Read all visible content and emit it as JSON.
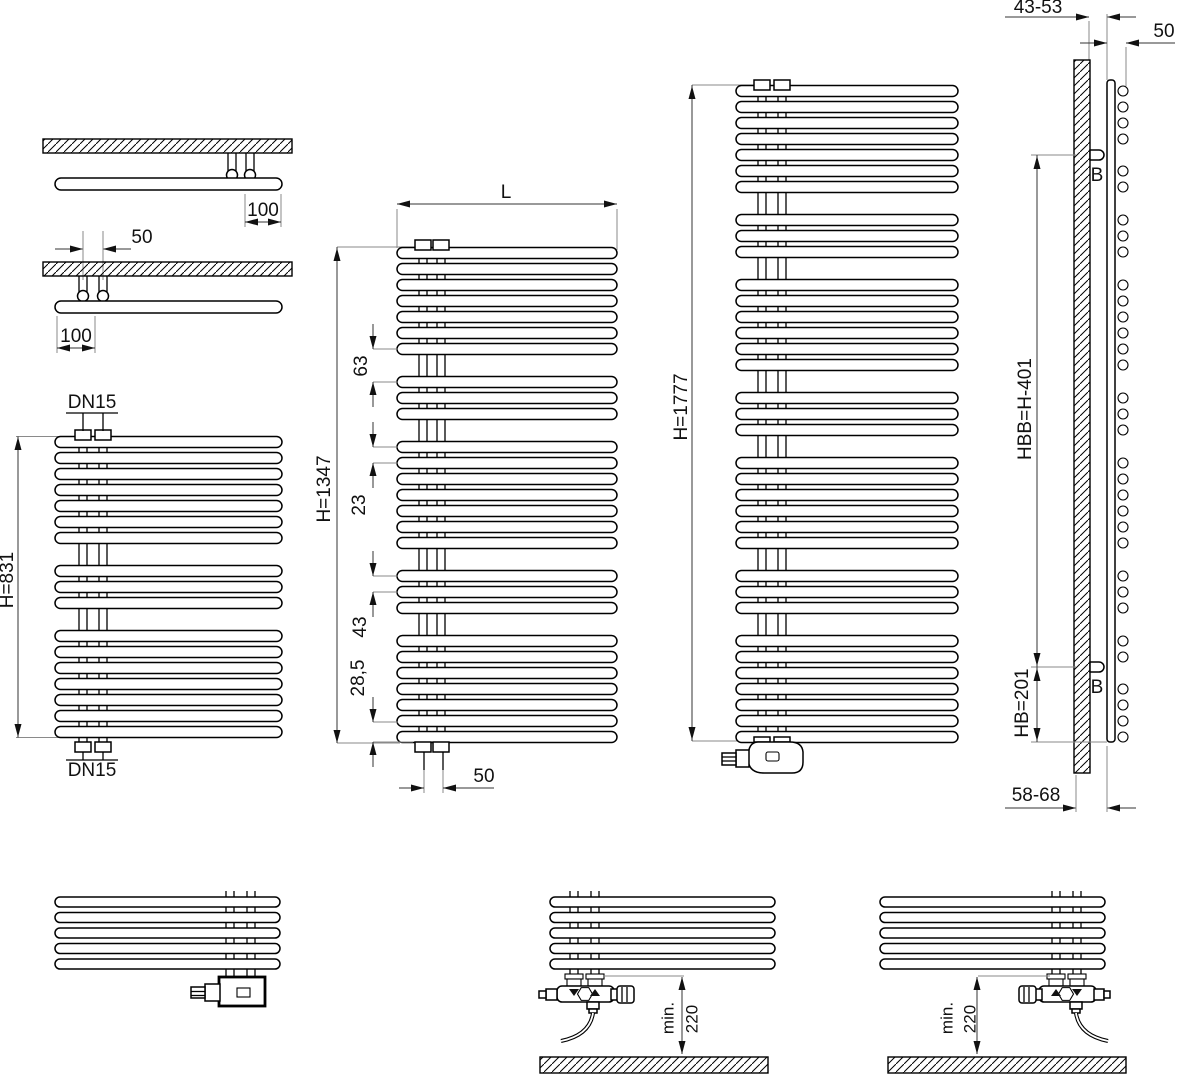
{
  "diagram": {
    "top_connection_detail": {
      "offset_right": "100",
      "pipe_spacing": "50",
      "offset_left": "100"
    },
    "radiator_h831": {
      "connection_top": "DN15",
      "connection_bottom": "DN15",
      "height": "H=831"
    },
    "radiator_h1347": {
      "width": "L",
      "height": "H=1347",
      "gap_pitch": "63",
      "tube_pitch": "23",
      "group_pitch": "43",
      "bottom_pitch": "28,5",
      "pipe_spacing": "50"
    },
    "radiator_h1777": {
      "height": "H=1777"
    },
    "side_view": {
      "wall_to_pipe": "43-53",
      "pipe_to_tube": "50",
      "bracket_top_label": "B",
      "bracket_distance": "HBB=H-401",
      "bracket_bottom_height": "HB=201",
      "bracket_bottom_label": "B",
      "wall_clearance": "58-68"
    },
    "installation_center": {
      "min": "min.",
      "clearance": "220"
    },
    "installation_right": {
      "min": "min.",
      "clearance": "220"
    }
  }
}
